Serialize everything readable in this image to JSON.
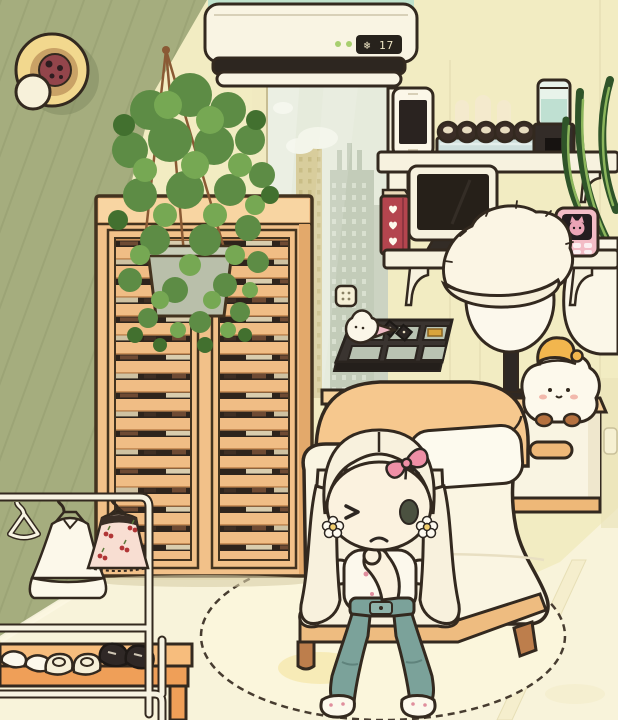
{
  "scene": {
    "room": "cozy cartoon bedroom",
    "style": "toca-style dollhouse game scene"
  },
  "ac_unit": {
    "display": "❄ 17",
    "temperature": "17",
    "mode_icon": "snowflake-icon",
    "status_lights": 2,
    "status_light_color": "#a8cf6f"
  },
  "palette": {
    "green_wall": "#a5ad7e",
    "yellow_wall": "#f2ecc2",
    "floor": "#f8f3da",
    "wardrobe_wood": "#f2c189",
    "bed_wood": "#f6c88e",
    "outline": "#33291f",
    "jeans_teal": "#7ba29a",
    "hair_blonde": "#f8f1dd",
    "skin": "#fbf2df",
    "accent_pink": "#ef8fa6",
    "plant_green": "#5d8c45",
    "rug_cream": "#fbf6dc"
  },
  "objects": {
    "wall_decor": "stacked round plates with cookie",
    "air_conditioner": "white split AC showing 17 degrees cooling",
    "hanging_plant": "macrame hanging ivy over wardrobe",
    "wardrobe": "tan louvered two-door wardrobe with clothes visible through slats",
    "window": "city skyline view with clouds",
    "wall_switch": "small square switch",
    "shelf_upper_items": [
      "white smartphone",
      "sushi tray with five rolls",
      "humidifier with teal water tank",
      "white vase plant with striped leaves"
    ],
    "shelf_lower_items": [
      "red heart book",
      "desktop monitor",
      "pink handheld pet device with cat screen"
    ],
    "desk_items": [
      "dark board game with six cells",
      "two dice",
      "gold piece",
      "soft-serve ghost piece"
    ],
    "lamp": "mannequin-head lamp wearing fluffy white visor hat",
    "bed": "cream bed with arched wooden headboard and pillow",
    "nightstand": "white nightstand with wooden handle",
    "plush": "white star plush wearing orange sleep hat",
    "clothing_rack": [
      "empty hanger",
      "white ruffle dress",
      "cherry print dress"
    ],
    "shoe_bench": [
      "white flats",
      "cream loafers",
      "black sneakers"
    ],
    "rug": "round cream rug with stitched edge",
    "character": {
      "appearance": "girl with long pale blonde hair",
      "expression": "winking with small frown",
      "accessories": [
        "pink bow",
        "white flower clips"
      ],
      "outfit": [
        "white floral top",
        "teal jeans",
        "white shoes"
      ]
    }
  }
}
